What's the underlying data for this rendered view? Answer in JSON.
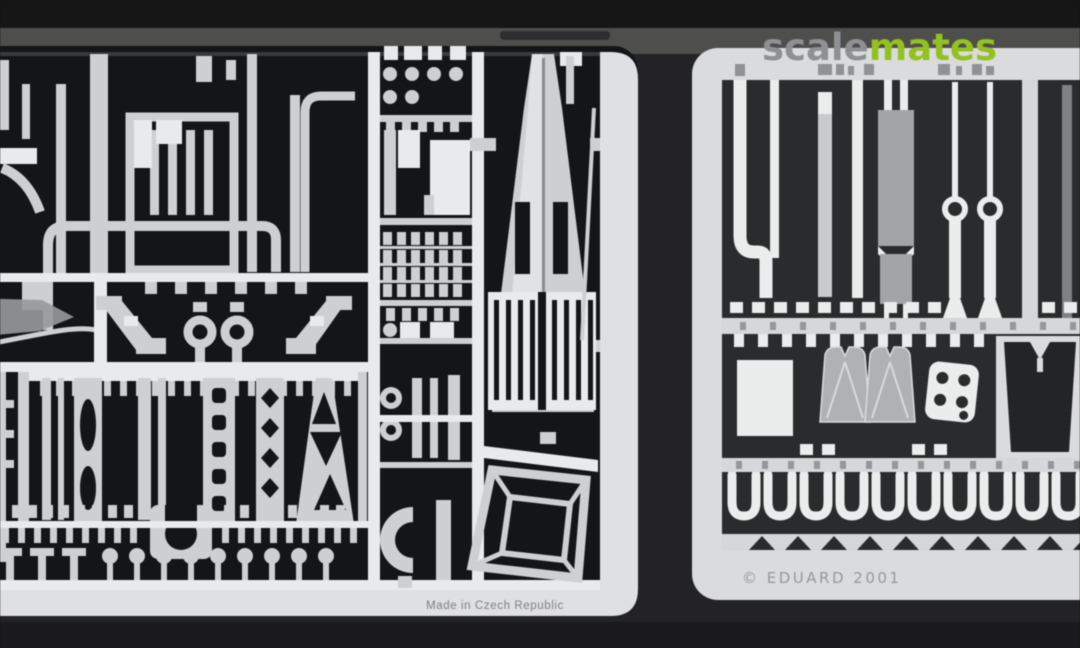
{
  "watermark": {
    "prefix": "scale",
    "suffix": "mates",
    "prefix_color": "#8e9093",
    "suffix_color": "#93c11f"
  },
  "left_fret": {
    "caption": "Made in Czech Republic",
    "caption_color": "#7f8082",
    "plate_color": "#141518",
    "border_color": "#dfe0e1",
    "parts_color": "#cdd0d2"
  },
  "right_fret": {
    "caption": "© EDUARD 2001",
    "caption_color": "#97989b",
    "plate_color": "#dadbdc",
    "panel_color": "#2a2b2d",
    "parts_color": "#ebecec",
    "gray_parts_color": "#aeafb1"
  },
  "background": {
    "top_color": "#161617",
    "band_color": "#4e4e4d",
    "floor_color": "#232325",
    "floor_dark_color": "#1a1a1c"
  }
}
